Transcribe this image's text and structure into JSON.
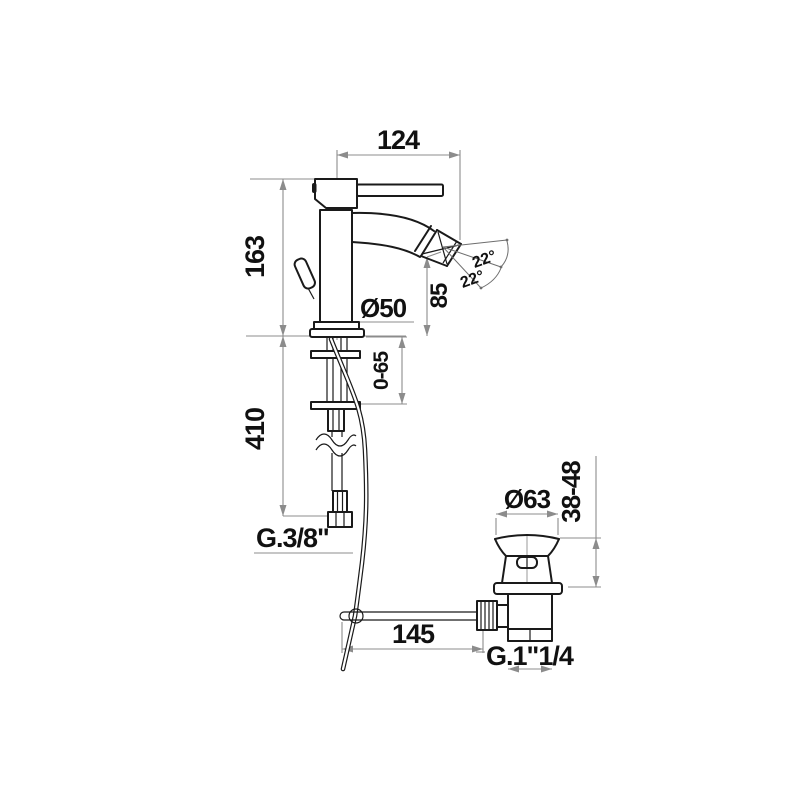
{
  "meta": {
    "drawing_type": "dimensioned technical line drawing",
    "product": "single-lever bidet mixer with flexible hose and pop-up waste"
  },
  "labels": {
    "spout_reach": "124",
    "body_height": "163",
    "base_diameter": "Ø50",
    "spout_height": "85",
    "swivel_up": "22°",
    "swivel_down": "22°",
    "deck_range": "0-65",
    "hose_length": "410",
    "supply_thread": "G.3/8\"",
    "waste_cap_diameter": "Ø63",
    "waste_height_range": "38-48",
    "rod_length": "145",
    "waste_thread": "G.1\"1/4"
  },
  "colors": {
    "object_line": "#1a1a1a",
    "dimension_line": "#8c8c8c",
    "label_text": "#111111",
    "background": "#ffffff"
  }
}
